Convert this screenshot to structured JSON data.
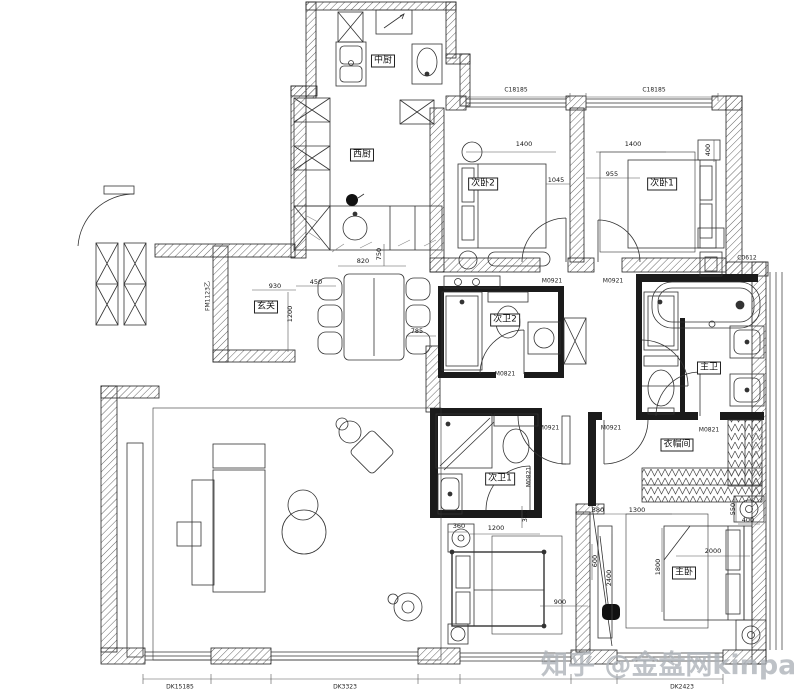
{
  "watermark": {
    "text": "知乎 @金盘网kinpan",
    "color": "#aeb4ba"
  },
  "rooms": {
    "zhongchu": "中厨",
    "xichu": "西厨",
    "ciwo2": "次卧2",
    "ciwo1": "次卧1",
    "xuanguan": "玄关",
    "ciwei2": "次卫2",
    "zhuwei": "主卫",
    "ciwei1": "次卫1",
    "yimaojian": "衣帽间",
    "zhuwo": "主卧"
  },
  "codes": {
    "window_top": "C18185",
    "window_side": "C0612",
    "door_0921": "M0921",
    "door_0821": "M0821",
    "entry_door": "FM1123乙",
    "bottom_left": "DK15185",
    "bottom_mid": "DK3323",
    "bottom_right": "DK2423"
  },
  "dims": {
    "n1400": "1400",
    "n1045": "1045",
    "n955": "955",
    "n400": "400",
    "n820": "820",
    "n750": "750",
    "n450": "450",
    "n930": "930",
    "n1200": "1200",
    "n785": "785",
    "n360": "360",
    "n390": "390",
    "n900": "900",
    "n380": "380",
    "n1300": "1300",
    "n550": "550",
    "n2000": "2000",
    "n1800": "1800",
    "n2400": "2400",
    "n600": "600"
  },
  "colors": {
    "wall": "#222222",
    "furniture": "#333333",
    "dimline": "#555555"
  }
}
